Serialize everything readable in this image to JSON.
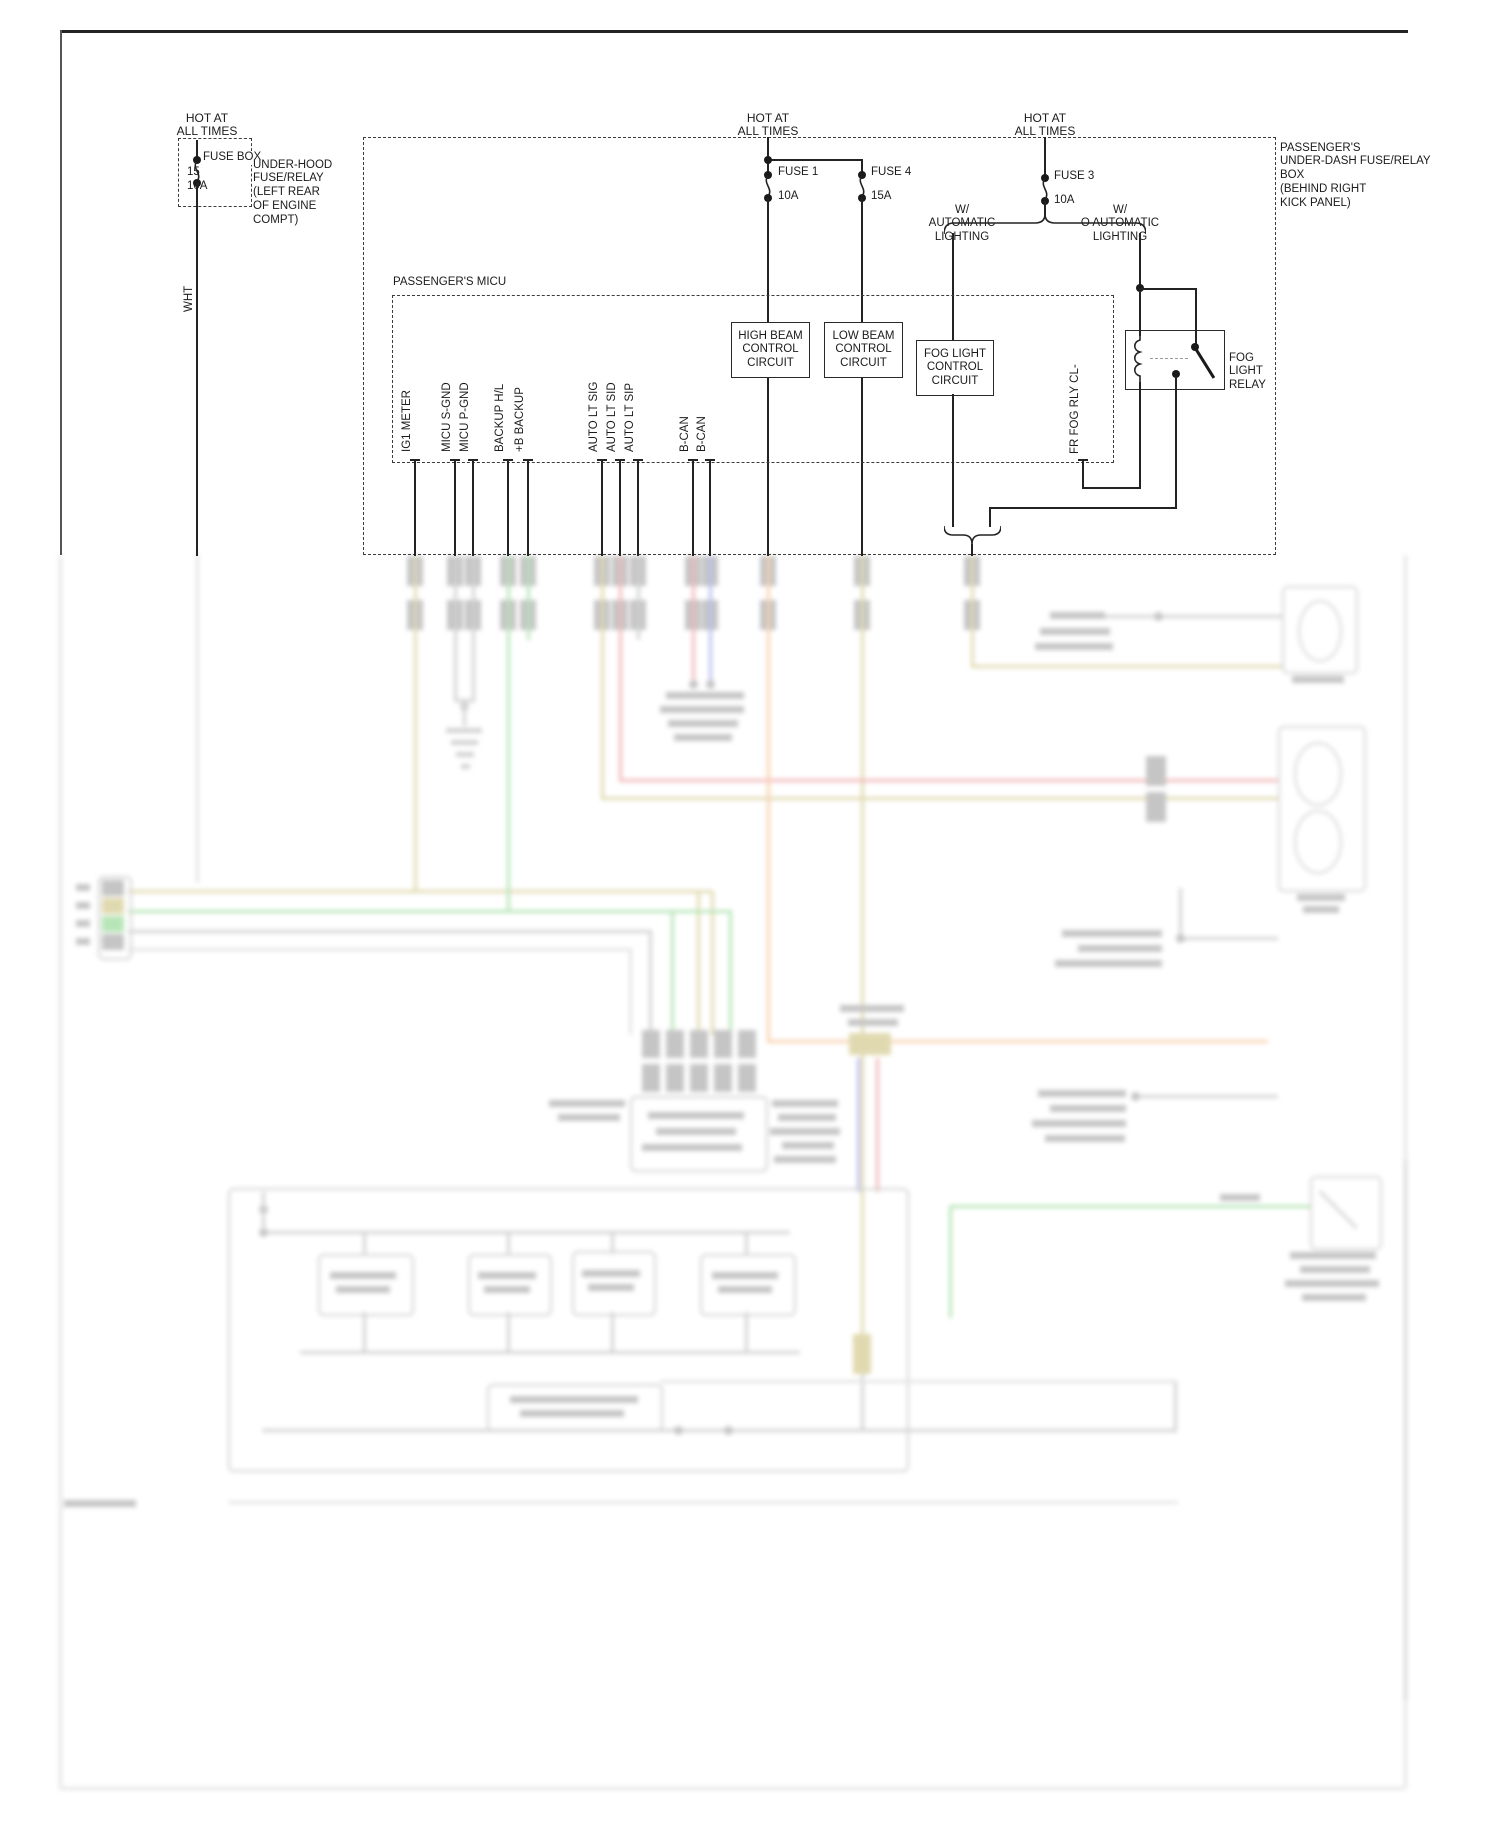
{
  "colors": {
    "line": "#232323",
    "tan": "#b4a23c",
    "green": "#4fbf4f",
    "red": "#e05252",
    "orange": "#ef8f3a",
    "blue": "#5560d0",
    "gray": "#8f8f8f",
    "lgray": "#bcbcbc",
    "block": "#6f6f6f",
    "comp": "#9a9a9a"
  },
  "labels": {
    "hot_left": [
      "HOT AT",
      "ALL TIMES"
    ],
    "hot_mid": [
      "HOT AT",
      "ALL TIMES"
    ],
    "hot_right": [
      "HOT AT",
      "ALL TIMES"
    ],
    "fuse_left": {
      "name": "FUSE BOX",
      "number": "15",
      "amps": "10A"
    },
    "underhood_note": [
      "UNDER-HOOD",
      "FUSE/RELAY",
      "(LEFT REAR",
      "OF ENGINE",
      "COMPT)"
    ],
    "wire_wht": "WHT",
    "fuse1": {
      "name": "FUSE 1",
      "amps": "10A"
    },
    "fuse4": {
      "name": "FUSE 4",
      "amps": "15A"
    },
    "fuse3": {
      "name": "FUSE 3",
      "amps": "10A"
    },
    "w_auto": [
      "W/",
      "AUTOMATIC",
      "LIGHTING"
    ],
    "wo_auto": [
      "W/",
      "O AUTOMATIC",
      "LIGHTING"
    ],
    "underdash_note": [
      "PASSENGER'S",
      "UNDER-DASH FUSE/RELAY",
      "BOX",
      "(BEHIND RIGHT",
      "KICK PANEL)"
    ],
    "micu_title": "PASSENGER'S MICU",
    "high_beam_box": [
      "HIGH BEAM",
      "CONTROL",
      "CIRCUIT"
    ],
    "low_beam_box": [
      "LOW BEAM",
      "CONTROL",
      "CIRCUIT"
    ],
    "fog_light_box": [
      "FOG LIGHT",
      "CONTROL",
      "CIRCUIT"
    ],
    "fog_relay": [
      "FOG",
      "LIGHT",
      "RELAY"
    ],
    "fr_fog_rly": "FR FOG RLY CL-",
    "micu_pins": [
      "IG1 METER",
      "MICU S-GND",
      "MICU P-GND",
      "BACKUP H/L",
      "+B BACKUP",
      "AUTO LT SIG",
      "AUTO LT SID",
      "AUTO LT SIP",
      "B-CAN",
      "B-CAN"
    ]
  }
}
